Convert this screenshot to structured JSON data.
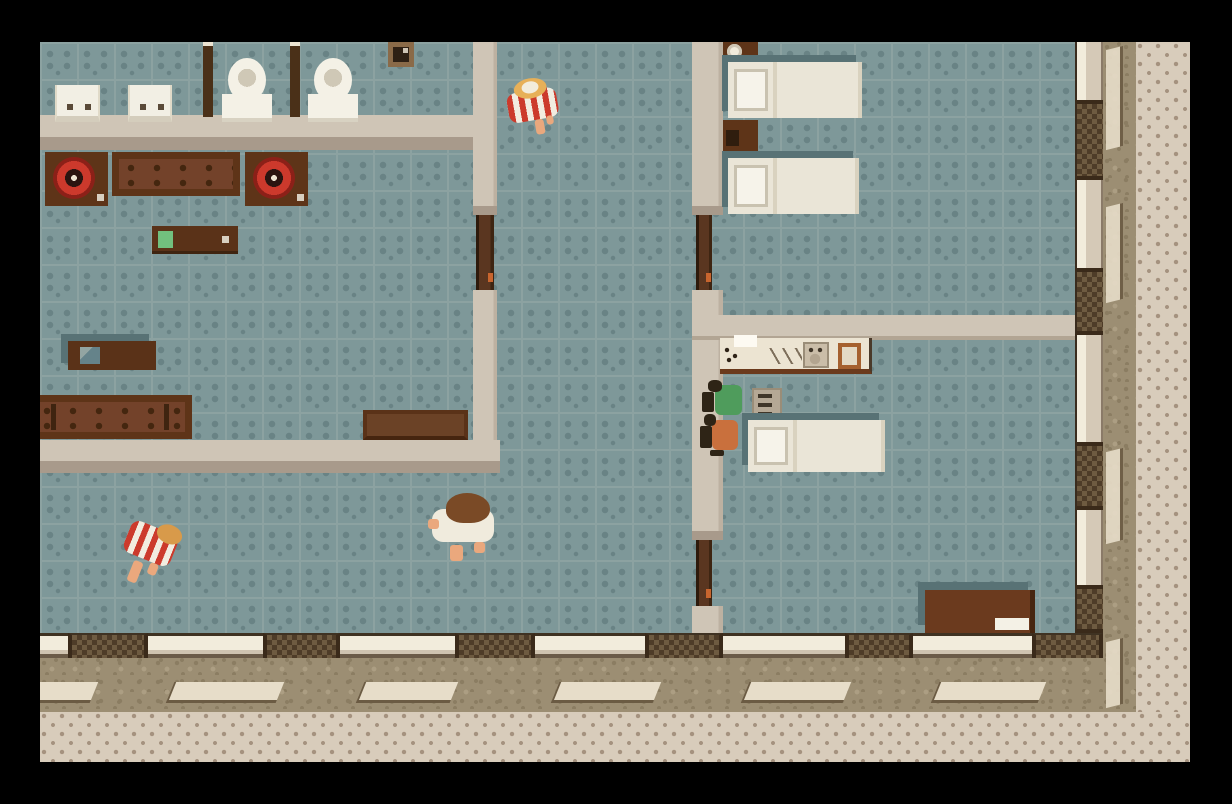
{
  "scene": {
    "viewport": {
      "x": 40,
      "y": 42,
      "width": 1150,
      "height": 720
    },
    "palette": {
      "floor": "#7E9899",
      "floorDot": "#698385",
      "floorLine": "#8CA2A1",
      "wall": "#CFC5B6",
      "wallShade": "#A89A8B",
      "grass": "#9C8E73",
      "grassDark": "#8B7D62",
      "grassLight": "#AC9E83",
      "stone": "#E7DDC9",
      "stoneEdge": "#6B5B43",
      "walk": "#D8CCBB",
      "walkDot": "#A5927F",
      "post": "#3A2A1A",
      "winDark": "#4E3C28",
      "winMid": "#6E5B41",
      "doorWood": "#5A3620",
      "doorDark": "#2E1A0C",
      "knob": "#C8652E",
      "bedWhite": "#EAE5D7",
      "bedShadow": "#587275",
      "red": "#CC3A2C",
      "skin": "#EAA87D",
      "dark": "#2E2416",
      "green": "#4F9C5C",
      "orange": "#C9703D",
      "hairBlonde": "#E7B058",
      "hairBrown": "#7A4A26"
    },
    "rooms": [
      "bathroom",
      "living-room",
      "hallway",
      "bedroom",
      "kitchen-bedroom",
      "street"
    ],
    "objects": [
      {
        "cls": "grass",
        "name": "lawn-right",
        "x": 1063,
        "y": 0,
        "w": 33,
        "h": 670
      },
      {
        "cls": "grass",
        "name": "lawn-bottom",
        "x": 0,
        "y": 616,
        "w": 1096,
        "h": 54
      },
      {
        "cls": "walk",
        "name": "sidewalk-right",
        "x": 1096,
        "y": 0,
        "w": 54,
        "h": 720
      },
      {
        "cls": "walk",
        "name": "sidewalk-bottom",
        "x": 0,
        "y": 670,
        "w": 1150,
        "h": 50
      },
      {
        "cls": "stone",
        "name": "paving-stone",
        "x": -14,
        "y": 640,
        "w": 66,
        "h": 18
      },
      {
        "cls": "stone",
        "name": "paving-stone",
        "x": 130,
        "y": 640,
        "w": 108,
        "h": 18
      },
      {
        "cls": "stone",
        "name": "paving-stone",
        "x": 320,
        "y": 640,
        "w": 92,
        "h": 18
      },
      {
        "cls": "stone",
        "name": "paving-stone",
        "x": 515,
        "y": 640,
        "w": 100,
        "h": 18
      },
      {
        "cls": "stone",
        "name": "paving-stone",
        "x": 705,
        "y": 640,
        "w": 100,
        "h": 18
      },
      {
        "cls": "stone",
        "name": "paving-stone",
        "x": 895,
        "y": 640,
        "w": 105,
        "h": 18
      },
      {
        "cls": "stone-v",
        "name": "paving-stone",
        "x": 1066,
        "y": 6,
        "w": 14,
        "h": 100
      },
      {
        "cls": "stone-v",
        "name": "paving-stone",
        "x": 1066,
        "y": 163,
        "w": 14,
        "h": 96
      },
      {
        "cls": "stone-v",
        "name": "paving-stone",
        "x": 1066,
        "y": 408,
        "w": 14,
        "h": 92
      },
      {
        "cls": "stone-v",
        "name": "paving-stone",
        "x": 1066,
        "y": 598,
        "w": 14,
        "h": 66
      },
      {
        "cls": "extwall-b",
        "name": "exterior-wall-south",
        "x": 0,
        "y": 591,
        "w": 1063,
        "h": 25
      },
      {
        "cls": "window-b",
        "name": "window",
        "x": 28,
        "y": 591,
        "w": 80,
        "h": 25
      },
      {
        "cls": "window-b",
        "name": "window",
        "x": 223,
        "y": 591,
        "w": 77,
        "h": 25
      },
      {
        "cls": "window-b",
        "name": "window",
        "x": 415,
        "y": 591,
        "w": 80,
        "h": 25
      },
      {
        "cls": "window-b",
        "name": "window",
        "x": 605,
        "y": 591,
        "w": 78,
        "h": 25
      },
      {
        "cls": "window-b",
        "name": "window",
        "x": 805,
        "y": 591,
        "w": 68,
        "h": 25
      },
      {
        "cls": "window-b",
        "name": "window",
        "x": 992,
        "y": 591,
        "w": 71,
        "h": 25
      },
      {
        "cls": "extwall-r",
        "name": "exterior-wall-east",
        "x": 1035,
        "y": 0,
        "w": 28,
        "h": 591
      },
      {
        "cls": "window-r",
        "name": "window",
        "x": 1035,
        "y": 58,
        "w": 28,
        "h": 80
      },
      {
        "cls": "window-r",
        "name": "window",
        "x": 1035,
        "y": 226,
        "w": 28,
        "h": 67
      },
      {
        "cls": "window-r",
        "name": "window",
        "x": 1035,
        "y": 400,
        "w": 28,
        "h": 68
      },
      {
        "cls": "window-r",
        "name": "window",
        "x": 1035,
        "y": 543,
        "w": 28,
        "h": 48
      },
      {
        "cls": "inwall-h",
        "name": "wall-bathroom-south",
        "x": 0,
        "y": 73,
        "w": 433,
        "h": 35
      },
      {
        "cls": "inwall-v",
        "name": "wall-hall-west-upper",
        "x": 433,
        "y": 0,
        "w": 24,
        "h": 164
      },
      {
        "cls": "wallcap",
        "name": "door-lintel",
        "x": 433,
        "y": 164,
        "w": 24,
        "h": 9
      },
      {
        "cls": "door-v",
        "name": "door-living-room",
        "x": 436,
        "y": 173,
        "w": 18,
        "h": 75,
        "inter": true
      },
      {
        "cls": "inwall-v",
        "name": "wall-hall-west-lower",
        "x": 433,
        "y": 248,
        "w": 24,
        "h": 150
      },
      {
        "cls": "inwall-h",
        "name": "wall-living-south",
        "x": 0,
        "y": 398,
        "w": 460,
        "h": 33
      },
      {
        "cls": "inwall-v",
        "name": "wall-hall-east-upper",
        "x": 652,
        "y": 0,
        "w": 31,
        "h": 164
      },
      {
        "cls": "wallcap",
        "name": "door-lintel",
        "x": 652,
        "y": 164,
        "w": 31,
        "h": 9
      },
      {
        "cls": "door-v",
        "name": "door-bedroom",
        "x": 656,
        "y": 173,
        "w": 16,
        "h": 75,
        "inter": true
      },
      {
        "cls": "inwall-v",
        "name": "wall-hall-east-middle",
        "x": 652,
        "y": 248,
        "w": 31,
        "h": 241
      },
      {
        "cls": "wallcap",
        "name": "door-lintel",
        "x": 652,
        "y": 489,
        "w": 31,
        "h": 9
      },
      {
        "cls": "door-v",
        "name": "door-kitchen",
        "x": 656,
        "y": 498,
        "w": 16,
        "h": 66,
        "inter": true
      },
      {
        "cls": "inwall-v",
        "name": "wall-hall-east-lower",
        "x": 652,
        "y": 564,
        "w": 31,
        "h": 27
      },
      {
        "cls": "inwall-h2",
        "name": "wall-bedroom-south",
        "x": 652,
        "y": 273,
        "w": 383,
        "h": 25
      },
      {
        "cls": "sink",
        "name": "bathroom-sink",
        "x": 15,
        "y": 43,
        "w": 45,
        "h": 37
      },
      {
        "cls": "sink",
        "name": "bathroom-sink",
        "x": 88,
        "y": 43,
        "w": 44,
        "h": 37
      },
      {
        "cls": "partition",
        "name": "stall-partition",
        "x": 163,
        "y": 0,
        "w": 10,
        "h": 75
      },
      {
        "cls": "toilet",
        "name": "toilet",
        "x": 182,
        "y": 16,
        "w": 50,
        "h": 64
      },
      {
        "cls": "partition",
        "name": "stall-partition",
        "x": 250,
        "y": 0,
        "w": 10,
        "h": 75
      },
      {
        "cls": "toilet",
        "name": "toilet",
        "x": 268,
        "y": 16,
        "w": 50,
        "h": 64
      },
      {
        "cls": "frame",
        "name": "wall-picture",
        "x": 348,
        "y": 0,
        "w": 26,
        "h": 25
      },
      {
        "cls": "turntable",
        "name": "turntable",
        "x": 5,
        "y": 110,
        "w": 63,
        "h": 54
      },
      {
        "cls": "sofa",
        "name": "sofa",
        "x": 72,
        "y": 110,
        "w": 128,
        "h": 44
      },
      {
        "cls": "turntable",
        "name": "turntable",
        "x": 205,
        "y": 110,
        "w": 63,
        "h": 54
      },
      {
        "cls": "sideboard",
        "name": "sideboard",
        "x": 112,
        "y": 184,
        "w": 86,
        "h": 28,
        "parts": [
          {
            "cls": "pad-green",
            "name": "green-item",
            "x": 6,
            "y": 5,
            "w": 15,
            "h": 17
          },
          {
            "cls": "dot-light",
            "name": "small-item",
            "x": 70,
            "y": 10,
            "w": 7,
            "h": 7
          }
        ]
      },
      {
        "cls": "tv-stand",
        "name": "tv-stand",
        "x": 28,
        "y": 299,
        "w": 88,
        "h": 29,
        "parts": [
          {
            "cls": "tv-screen",
            "name": "tv",
            "x": 12,
            "y": 6,
            "w": 20,
            "h": 17
          }
        ]
      },
      {
        "cls": "sofa sofa-long",
        "name": "sofa-long",
        "x": -12,
        "y": 353,
        "w": 164,
        "h": 44
      },
      {
        "cls": "bench",
        "name": "bench",
        "x": 323,
        "y": 368,
        "w": 105,
        "h": 30
      },
      {
        "cls": "nightstand",
        "name": "nightstand",
        "x": 683,
        "y": 0,
        "w": 35,
        "h": 21,
        "parts": [
          {
            "cls": "cup",
            "name": "cup",
            "x": 4,
            "y": 2,
            "w": 15,
            "h": 15
          }
        ]
      },
      {
        "cls": "bed",
        "name": "bed",
        "x": 688,
        "y": 20,
        "w": 134,
        "h": 56
      },
      {
        "cls": "nightstand",
        "name": "nightstand",
        "x": 683,
        "y": 78,
        "w": 35,
        "h": 36,
        "parts": [
          {
            "cls": "handle-dark",
            "name": "drawer-handle",
            "x": 3,
            "y": 10,
            "w": 13,
            "h": 16
          }
        ]
      },
      {
        "cls": "bed",
        "name": "bed",
        "x": 688,
        "y": 116,
        "w": 131,
        "h": 56
      },
      {
        "cls": "counter",
        "name": "kitchen-counter",
        "x": 680,
        "y": 296,
        "w": 152,
        "h": 36,
        "parts": [
          {
            "cls": "towel",
            "name": "towel",
            "x": 14,
            "y": -3,
            "w": 23,
            "h": 12
          },
          {
            "cls": "marks",
            "name": "cutlery",
            "x": 4,
            "y": 8,
            "w": 16,
            "h": 18
          },
          {
            "cls": "utensil",
            "name": "knives",
            "x": 48,
            "y": 10,
            "w": 34,
            "h": 16
          },
          {
            "cls": "sink-unit",
            "name": "kitchen-sink",
            "x": 83,
            "y": 4,
            "w": 26,
            "h": 26
          },
          {
            "cls": "board",
            "name": "cutting-board",
            "x": 118,
            "y": 5,
            "w": 23,
            "h": 26
          }
        ]
      },
      {
        "cls": "radiator",
        "name": "appliance",
        "x": 712,
        "y": 346,
        "w": 30,
        "h": 33
      },
      {
        "cls": "bed",
        "name": "bed",
        "x": 708,
        "y": 378,
        "w": 137,
        "h": 52
      },
      {
        "cls": "desk",
        "name": "desk",
        "x": 885,
        "y": 548,
        "w": 110,
        "h": 43,
        "parts": [
          {
            "cls": "paper",
            "name": "paper",
            "x": 70,
            "y": 28,
            "w": 34,
            "h": 12
          }
        ]
      },
      {
        "cls": "char char-rot-l",
        "name": "guest-striped-shirt",
        "x": 468,
        "y": 36,
        "w": 52,
        "h": 58,
        "inter": true,
        "parts": [
          {
            "cls": "body-striped",
            "name": "striped-shirt",
            "x": 0,
            "y": 12,
            "w": 50,
            "h": 30
          },
          {
            "cls": "hair-blonde",
            "name": "blonde-hair",
            "x": 9,
            "y": 0,
            "w": 33,
            "h": 20
          },
          {
            "cls": "cap-white",
            "name": "head-highlight",
            "x": 17,
            "y": 3,
            "w": 17,
            "h": 12
          },
          {
            "cls": "skin",
            "name": "leg",
            "x": 24,
            "y": 42,
            "w": 9,
            "h": 15
          },
          {
            "cls": "skin",
            "name": "leg",
            "x": 36,
            "y": 40,
            "w": 7,
            "h": 9
          }
        ]
      },
      {
        "cls": "char char-rot-r",
        "name": "guest-striped-shirt",
        "x": 78,
        "y": 476,
        "w": 57,
        "h": 80,
        "inter": true,
        "parts": [
          {
            "cls": "body-striped",
            "name": "striped-shirt",
            "x": 2,
            "y": 8,
            "w": 50,
            "h": 34
          },
          {
            "cls": "hair-blonde2",
            "name": "blonde-hair",
            "x": 28,
            "y": 0,
            "w": 26,
            "h": 19
          },
          {
            "cls": "skin",
            "name": "leg",
            "x": 18,
            "y": 46,
            "w": 10,
            "h": 22
          },
          {
            "cls": "skin",
            "name": "leg",
            "x": 34,
            "y": 42,
            "w": 9,
            "h": 12
          }
        ]
      },
      {
        "cls": "char",
        "name": "guest-white-shirt",
        "x": 388,
        "y": 451,
        "w": 76,
        "h": 74,
        "inter": true,
        "parts": [
          {
            "cls": "body-white",
            "name": "white-shirt",
            "x": 4,
            "y": 16,
            "w": 62,
            "h": 33
          },
          {
            "cls": "hair-brown",
            "name": "brown-hair",
            "x": 18,
            "y": 0,
            "w": 44,
            "h": 30
          },
          {
            "cls": "skin",
            "name": "arm",
            "x": 0,
            "y": 26,
            "w": 11,
            "h": 10
          },
          {
            "cls": "skin",
            "name": "leg",
            "x": 22,
            "y": 52,
            "w": 13,
            "h": 16
          },
          {
            "cls": "skin",
            "name": "leg",
            "x": 46,
            "y": 49,
            "w": 11,
            "h": 11
          }
        ]
      },
      {
        "cls": "char",
        "name": "figure-green",
        "x": 662,
        "y": 338,
        "w": 42,
        "h": 40,
        "inter": true,
        "parts": [
          {
            "cls": "dark-bit",
            "name": "held-item",
            "x": 0,
            "y": 12,
            "w": 12,
            "h": 20
          },
          {
            "cls": "body-green",
            "name": "green-shirt",
            "x": 13,
            "y": 5,
            "w": 27,
            "h": 30
          },
          {
            "cls": "hair-dark",
            "name": "dark-hair",
            "x": 6,
            "y": 0,
            "w": 14,
            "h": 12
          }
        ]
      },
      {
        "cls": "char",
        "name": "figure-orange",
        "x": 660,
        "y": 370,
        "w": 42,
        "h": 44,
        "inter": true,
        "parts": [
          {
            "cls": "dark-bit",
            "name": "held-item",
            "x": 0,
            "y": 14,
            "w": 12,
            "h": 22
          },
          {
            "cls": "body-orange",
            "name": "orange-shirt",
            "x": 12,
            "y": 8,
            "w": 26,
            "h": 30
          },
          {
            "cls": "hair-dark",
            "name": "dark-hair",
            "x": 4,
            "y": 2,
            "w": 12,
            "h": 12
          },
          {
            "cls": "dark-bit",
            "name": "shadow-bit",
            "x": 10,
            "y": 38,
            "w": 14,
            "h": 6
          }
        ]
      }
    ]
  }
}
